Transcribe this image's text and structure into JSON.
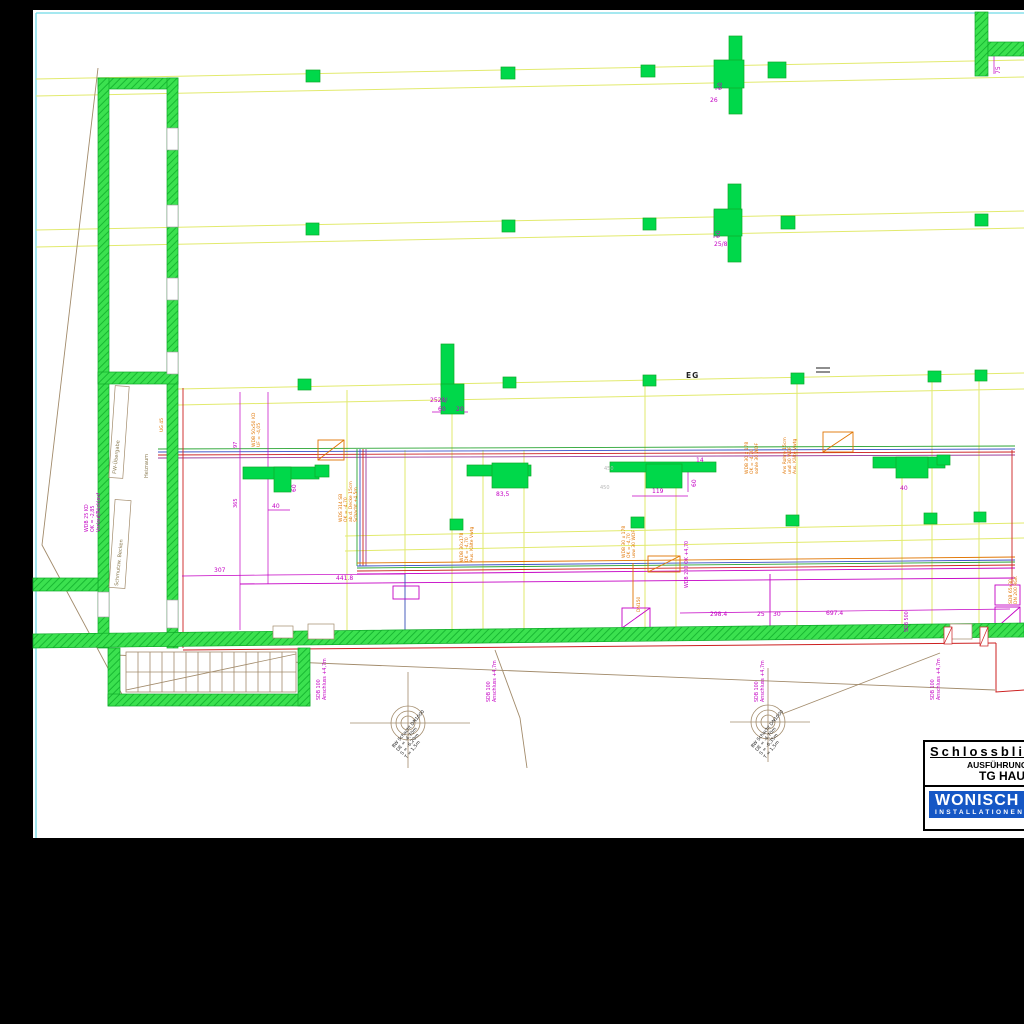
{
  "colors": {
    "wall_green": "#33d94f",
    "column_green": "#00d84a",
    "grid_yellow": "#e2ea6e",
    "dim_magenta": "#c400c4",
    "annot_orange": "#e07400",
    "pipe_red": "#cc2020",
    "pipe_blue": "#3a50c8",
    "pipe_green": "#28a432",
    "pipe_purple": "#993b99",
    "frame_cyan": "#6fd9e6",
    "line_brown": "#a28b6b",
    "logo_blue": "#1557c5"
  },
  "title_block": {
    "project": "Schlossblick",
    "phase": "AUSFÜHRUNG",
    "drawing": "TG HAUS",
    "brand": "WONISCH",
    "brand_sub": "INSTALLATIONEN"
  },
  "axis": {
    "eg": "EG"
  },
  "rooms": {
    "fw_uebergabe": "FW-Übergabe",
    "heizraum": "Heizraum",
    "schmutzbecken": "Schmutzw. Becken"
  },
  "dims": {
    "d_60": "60",
    "d_26": "26",
    "d_25_8": "25/8",
    "d_2528": "2528/",
    "d_20": "20",
    "d_83_5": "83,5",
    "d_119": "119",
    "d_14": "14",
    "d_40": "40",
    "d_307": "307",
    "d_441": "441.8",
    "d_298": "298.4",
    "d_25": "25",
    "d_30": "30",
    "d_697": "697.4",
    "d_75": "75",
    "d_365": "365",
    "d_97": "97",
    "d_450": "450"
  },
  "wall_labels": {
    "sdb": "SDB 100",
    "anschluss": "Anschluss +4,7m",
    "wdb200": "WDB 200 OK +4,70",
    "sdb500": "SDB 500",
    "wdb25": "WDB 25 KD",
    "ok285": "OK = -2,85",
    "vorlauf": "Vorlauf/Rücklauf",
    "dn150": "DN150",
    "ug45": "UG 45"
  },
  "pipe_notes": {
    "a": [
      "WDS 314 SB",
      "OK = -4,70",
      "ab d. Decke 15cm",
      "Schacht +4,5m"
    ],
    "b": [
      "WDB 50x50 KD",
      "UF = -4,05"
    ],
    "c": [
      "WDB 30 x 178",
      "OK = -4,70",
      "sohle 30 WDF"
    ],
    "d": [
      "Ans Rohre 15cm",
      "und 30 WDF",
      "Aus. Kälte Vwtg"
    ],
    "e": [
      "WDB 30x178",
      "OK = -4,70",
      "Aus. Kälte Vwtg"
    ],
    "f": [
      "WDB 30 x 178",
      "OK = -4,70",
      "usw 30 WDF"
    ],
    "g": [
      "SDB 65x30",
      "DN 200 RGK"
    ]
  },
  "manholes": {
    "m1": [
      "BW Schacht DN1000",
      "DE = -4,70m",
      "S = -6,20m",
      "T = 1,5m"
    ],
    "m2": [
      "BW Schacht DN1000",
      "DE = -4,70m",
      "S = -6,35m",
      "T = 1,5m"
    ]
  }
}
